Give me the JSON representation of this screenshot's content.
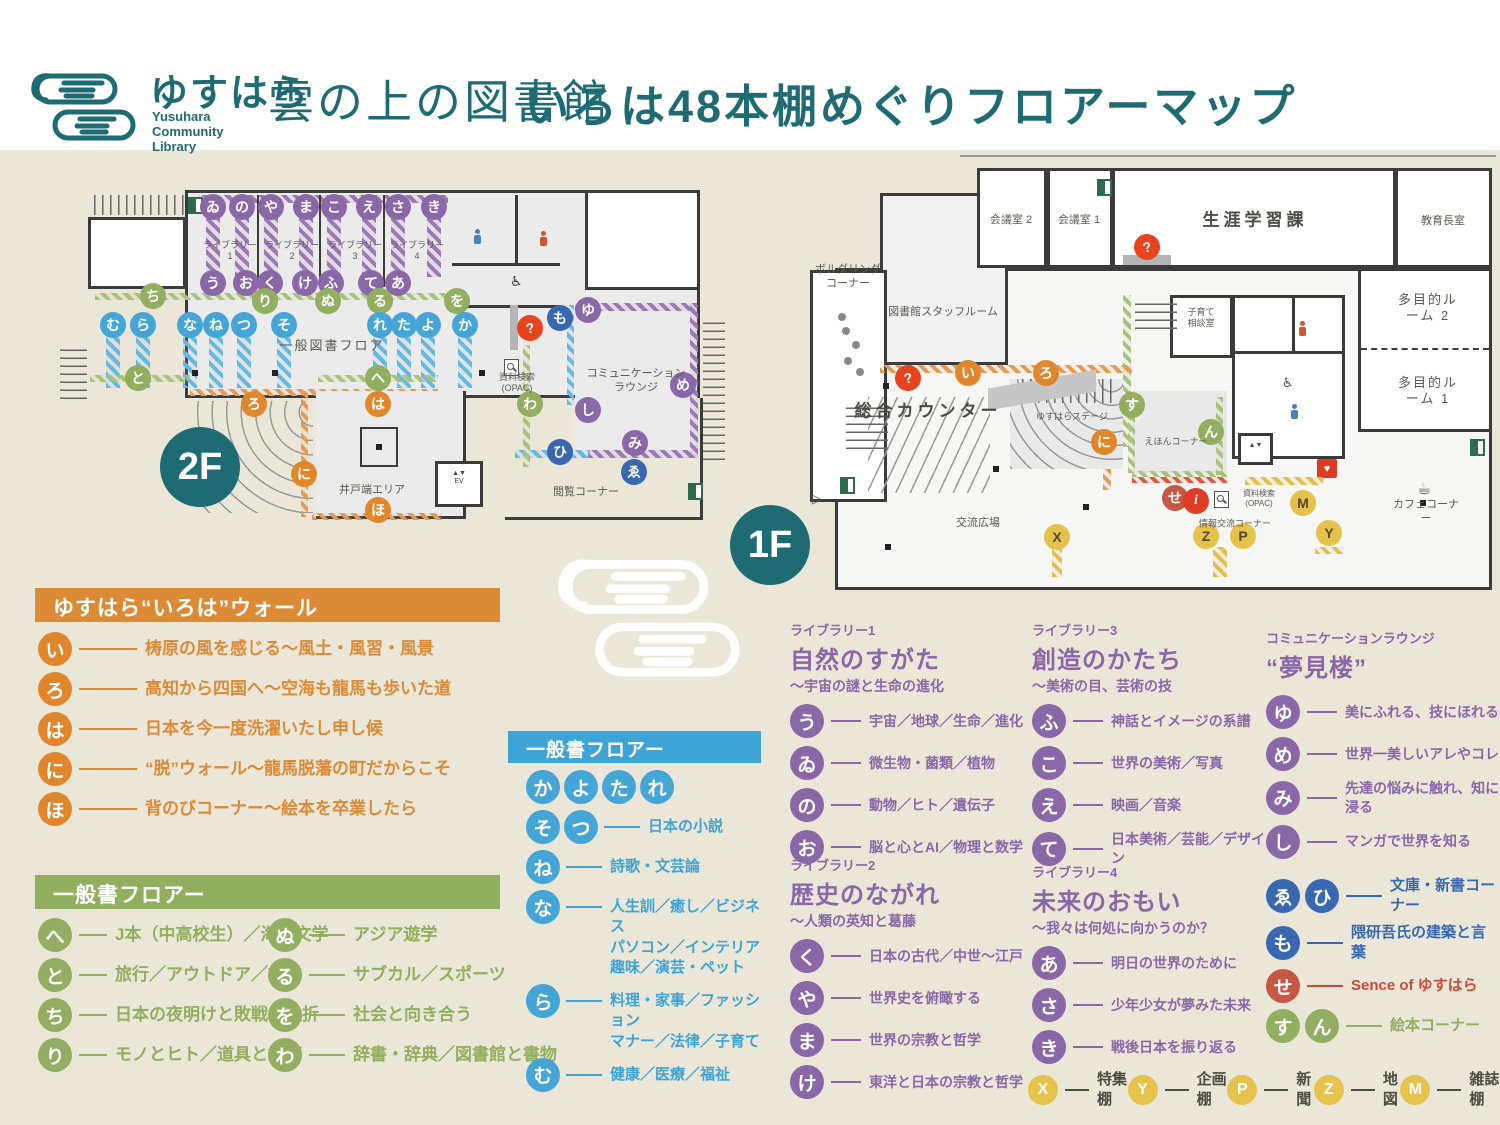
{
  "header": {
    "brand_jp": "ゆすはら",
    "brand_en": "Yusuhara\nCommunity\nLibrary",
    "brand_logotype": "雲の上の図書館",
    "title": "いろは48本棚めぐりフロアーマップ"
  },
  "colors": {
    "teal": "#1e6b74",
    "orange": "#dd8a36",
    "green": "#92ae5f",
    "blue": "#3ea3d5",
    "purple": "#8a67a6",
    "navy": "#3a68b0",
    "brick": "#cb4a35",
    "red": "#e8431f",
    "yellow": "#e5c24c",
    "cream": "#eae6d8",
    "ink": "#3b3b3c"
  },
  "floor2": {
    "badge": "2F",
    "markers": [
      {
        "ch": "ゐ",
        "c": "purple",
        "x": 153,
        "y": 42
      },
      {
        "ch": "の",
        "c": "purple",
        "x": 182,
        "y": 42
      },
      {
        "ch": "や",
        "c": "purple",
        "x": 211,
        "y": 42
      },
      {
        "ch": "ま",
        "c": "purple",
        "x": 246,
        "y": 42
      },
      {
        "ch": "こ",
        "c": "purple",
        "x": 274,
        "y": 42
      },
      {
        "ch": "え",
        "c": "purple",
        "x": 309,
        "y": 42
      },
      {
        "ch": "さ",
        "c": "purple",
        "x": 338,
        "y": 42
      },
      {
        "ch": "き",
        "c": "purple",
        "x": 374,
        "y": 42
      },
      {
        "ch": "う",
        "c": "purple",
        "x": 153,
        "y": 118
      },
      {
        "ch": "お",
        "c": "purple",
        "x": 186,
        "y": 118
      },
      {
        "ch": "く",
        "c": "purple",
        "x": 210,
        "y": 118
      },
      {
        "ch": "け",
        "c": "purple",
        "x": 245,
        "y": 118
      },
      {
        "ch": "ふ",
        "c": "purple",
        "x": 271,
        "y": 118
      },
      {
        "ch": "て",
        "c": "purple",
        "x": 311,
        "y": 118
      },
      {
        "ch": "あ",
        "c": "purple",
        "x": 338,
        "y": 118
      },
      {
        "ch": "ち",
        "c": "green",
        "x": 93,
        "y": 131
      },
      {
        "ch": "り",
        "c": "green",
        "x": 205,
        "y": 136
      },
      {
        "ch": "ぬ",
        "c": "green",
        "x": 268,
        "y": 136
      },
      {
        "ch": "る",
        "c": "green",
        "x": 320,
        "y": 136
      },
      {
        "ch": "を",
        "c": "green",
        "x": 397,
        "y": 136
      },
      {
        "ch": "と",
        "c": "green",
        "x": 78,
        "y": 213
      },
      {
        "ch": "へ",
        "c": "green",
        "x": 318,
        "y": 213
      },
      {
        "ch": "わ",
        "c": "green",
        "x": 470,
        "y": 239
      },
      {
        "ch": "む",
        "c": "blue",
        "x": 53,
        "y": 160
      },
      {
        "ch": "ら",
        "c": "blue",
        "x": 83,
        "y": 160
      },
      {
        "ch": "な",
        "c": "blue",
        "x": 130,
        "y": 160
      },
      {
        "ch": "ね",
        "c": "blue",
        "x": 156,
        "y": 160
      },
      {
        "ch": "つ",
        "c": "blue",
        "x": 184,
        "y": 160
      },
      {
        "ch": "そ",
        "c": "blue",
        "x": 224,
        "y": 160
      },
      {
        "ch": "れ",
        "c": "blue",
        "x": 320,
        "y": 160
      },
      {
        "ch": "た",
        "c": "blue",
        "x": 344,
        "y": 160
      },
      {
        "ch": "よ",
        "c": "blue",
        "x": 368,
        "y": 160
      },
      {
        "ch": "か",
        "c": "blue",
        "x": 405,
        "y": 160
      },
      {
        "ch": "ろ",
        "c": "orange",
        "x": 194,
        "y": 239
      },
      {
        "ch": "は",
        "c": "orange",
        "x": 318,
        "y": 239
      },
      {
        "ch": "に",
        "c": "orange",
        "x": 244,
        "y": 309
      },
      {
        "ch": "ほ",
        "c": "orange",
        "x": 318,
        "y": 345
      },
      {
        "ch": "も",
        "c": "navy",
        "x": 500,
        "y": 153
      },
      {
        "ch": "ひ",
        "c": "navy",
        "x": 500,
        "y": 287
      },
      {
        "ch": "ゑ",
        "c": "navy",
        "x": 574,
        "y": 307
      },
      {
        "ch": "ゆ",
        "c": "purple",
        "x": 528,
        "y": 145
      },
      {
        "ch": "し",
        "c": "purple",
        "x": 528,
        "y": 245
      },
      {
        "ch": "め",
        "c": "purple",
        "x": 623,
        "y": 220
      },
      {
        "ch": "み",
        "c": "purple",
        "x": 575,
        "y": 278
      },
      {
        "ch": "?",
        "c": "help",
        "x": 470,
        "y": 163
      }
    ],
    "labels": [
      {
        "t": "ライブラリー\n1",
        "x": 170,
        "y": 86,
        "s": "xs"
      },
      {
        "t": "ライブラリー\n2",
        "x": 232,
        "y": 86,
        "s": "xs"
      },
      {
        "t": "ライブラリー\n3",
        "x": 295,
        "y": 86,
        "s": "xs"
      },
      {
        "t": "ライブラリー\n4",
        "x": 357,
        "y": 86,
        "s": "xs"
      },
      {
        "t": "一般図書フロア",
        "x": 272,
        "y": 181,
        "s": "md"
      },
      {
        "t": "井戸端エリア",
        "x": 312,
        "y": 326,
        "s": "sm"
      },
      {
        "t": "コミュニケーション\nラウンジ",
        "x": 576,
        "y": 216,
        "s": "sm"
      },
      {
        "t": "閲覧コーナー",
        "x": 526,
        "y": 328,
        "s": "sm"
      },
      {
        "t": "資料検索\n(OPAC)",
        "x": 457,
        "y": 218,
        "s": "xs"
      }
    ]
  },
  "floor1": {
    "badge": "1F",
    "markers": [
      {
        "ch": "?",
        "c": "help",
        "x": 98,
        "y": 223
      },
      {
        "ch": "?",
        "c": "help",
        "x": 337,
        "y": 92
      },
      {
        "ch": "い",
        "c": "orange",
        "x": 158,
        "y": 218
      },
      {
        "ch": "ろ",
        "c": "orange",
        "x": 236,
        "y": 218
      },
      {
        "ch": "に",
        "c": "orange",
        "x": 294,
        "y": 287
      },
      {
        "ch": "す",
        "c": "green",
        "x": 322,
        "y": 250
      },
      {
        "ch": "ん",
        "c": "green",
        "x": 401,
        "y": 277
      },
      {
        "ch": "せ",
        "c": "brick",
        "x": 365,
        "y": 343
      },
      {
        "ch": "i",
        "c": "info",
        "x": 386,
        "y": 346
      },
      {
        "ch": "M",
        "c": "yellow",
        "x": 493,
        "y": 348
      },
      {
        "ch": "X",
        "c": "yellow",
        "x": 247,
        "y": 382
      },
      {
        "ch": "Z",
        "c": "yellow",
        "x": 396,
        "y": 381
      },
      {
        "ch": "P",
        "c": "yellow",
        "x": 433,
        "y": 381
      },
      {
        "ch": "Y",
        "c": "yellow",
        "x": 519,
        "y": 378
      }
    ],
    "labels": [
      {
        "t": "ボルダリング\nコーナー",
        "x": 38,
        "y": 122,
        "s": "sm"
      },
      {
        "t": "図書館スタッフルーム",
        "x": 133,
        "y": 158,
        "s": "sm"
      },
      {
        "t": "会議室 2",
        "x": 201,
        "y": 66,
        "s": "sm"
      },
      {
        "t": "会議室 1",
        "x": 269,
        "y": 66,
        "s": "sm"
      },
      {
        "t": "生涯学習課",
        "x": 445,
        "y": 65,
        "s": "lg"
      },
      {
        "t": "教育長室",
        "x": 633,
        "y": 67,
        "s": "sm"
      },
      {
        "t": "多目的ルーム 2",
        "x": 618,
        "y": 153,
        "s": "md"
      },
      {
        "t": "多目的ルーム 1",
        "x": 618,
        "y": 236,
        "s": "md"
      },
      {
        "t": "子育て\n相談室",
        "x": 391,
        "y": 163,
        "s": "xs"
      },
      {
        "t": "総合カウンター",
        "x": 118,
        "y": 256,
        "s": "lg"
      },
      {
        "t": "ゆすはらステージ",
        "x": 262,
        "y": 262,
        "s": "xs"
      },
      {
        "t": "えほんコーナー",
        "x": 366,
        "y": 287,
        "s": "xs"
      },
      {
        "t": "交流広場",
        "x": 168,
        "y": 369,
        "s": "sm"
      },
      {
        "t": "情報交流コーナー",
        "x": 425,
        "y": 369,
        "s": "xs"
      },
      {
        "t": "カフェコーナー",
        "x": 616,
        "y": 357,
        "s": "sm"
      },
      {
        "t": "資料検索\n(OPAC)",
        "x": 449,
        "y": 344,
        "s": "xxs"
      }
    ]
  },
  "legend_orange": {
    "title": "ゆすはら“いろは”ウォール",
    "items": [
      {
        "ch": "い",
        "text": "梼原の風を感じる〜風土・風習・風景"
      },
      {
        "ch": "ろ",
        "text": "高知から四国へ〜空海も龍馬も歩いた道"
      },
      {
        "ch": "は",
        "text": "日本を今一度洗濯いたし申し候"
      },
      {
        "ch": "に",
        "text": "“脱”ウォール〜龍馬脱藩の町だからこそ"
      },
      {
        "ch": "ほ",
        "text": "背のびコーナー〜絵本を卒業したら"
      }
    ]
  },
  "legend_green": {
    "title": "一般書フロアー",
    "items_left": [
      {
        "ch": "へ",
        "text": "J本（中高校生）／海外文学"
      },
      {
        "ch": "と",
        "text": "旅行／アウトドア／語学"
      },
      {
        "ch": "ち",
        "text": "日本の夜明けと敗戦の挫折"
      },
      {
        "ch": "り",
        "text": "モノとヒト／道具と技術"
      }
    ],
    "items_right": [
      {
        "ch": "ぬ",
        "text": "アジア遊学"
      },
      {
        "ch": "る",
        "text": "サブカル／スポーツ"
      },
      {
        "ch": "を",
        "text": "社会と向き合う"
      },
      {
        "ch": "わ",
        "text": "辞書・辞典／図書館と書物"
      }
    ]
  },
  "legend_blue": {
    "title": "一般書フロアー",
    "groups": [
      {
        "chars": [
          "か",
          "よ",
          "た",
          "れ"
        ],
        "text": ""
      },
      {
        "chars": [
          "そ",
          "つ"
        ],
        "text": "日本の小説"
      },
      {
        "chars": [
          "ね"
        ],
        "text": "詩歌・文芸論"
      },
      {
        "chars": [
          "な"
        ],
        "text": "人生訓／癒し／ビジネス\nパソコン／インテリア\n趣味／演芸・ペット"
      },
      {
        "chars": [
          "ら"
        ],
        "text": "料理・家事／ファッション\nマナー／法律／子育て"
      },
      {
        "chars": [
          "む"
        ],
        "text": "健康／医療／福祉"
      }
    ]
  },
  "libraries": [
    {
      "tag": "ライブラリー1",
      "title": "自然のすがた",
      "subtitle": "〜宇宙の謎と生命の進化",
      "items": [
        {
          "ch": "う",
          "text": "宇宙／地球／生命／進化"
        },
        {
          "ch": "ゐ",
          "text": "微生物・菌類／植物"
        },
        {
          "ch": "の",
          "text": "動物／ヒト／遺伝子"
        },
        {
          "ch": "お",
          "text": "脳と心とAI／物理と数学"
        }
      ]
    },
    {
      "tag": "ライブラリー2",
      "title": "歴史のながれ",
      "subtitle": "〜人類の英知と葛藤",
      "items": [
        {
          "ch": "く",
          "text": "日本の古代／中世〜江戸"
        },
        {
          "ch": "や",
          "text": "世界史を俯瞰する"
        },
        {
          "ch": "ま",
          "text": "世界の宗教と哲学"
        },
        {
          "ch": "け",
          "text": "東洋と日本の宗教と哲学"
        }
      ]
    },
    {
      "tag": "ライブラリー3",
      "title": "創造のかたち",
      "subtitle": "〜美術の目、芸術の技",
      "items": [
        {
          "ch": "ふ",
          "text": "神話とイメージの系譜"
        },
        {
          "ch": "こ",
          "text": "世界の美術／写真"
        },
        {
          "ch": "え",
          "text": "映画／音楽"
        },
        {
          "ch": "て",
          "text": "日本美術／芸能／デザイン"
        }
      ]
    },
    {
      "tag": "ライブラリー4",
      "title": "未来のおもい",
      "subtitle": "〜我々は何処に向かうのか？",
      "items": [
        {
          "ch": "あ",
          "text": "明日の世界のために"
        },
        {
          "ch": "さ",
          "text": "少年少女が夢みた未来"
        },
        {
          "ch": "き",
          "text": "戦後日本を振り返る"
        }
      ]
    }
  ],
  "lounge": {
    "tag": "コミュニケーションラウンジ",
    "title": "“夢見楼”",
    "items": [
      {
        "ch": "ゆ",
        "text": "美にふれる、技にほれる"
      },
      {
        "ch": "め",
        "text": "世界一美しいアレやコレ"
      },
      {
        "ch": "み",
        "text": "先達の悩みに触れ、知に浸る"
      },
      {
        "ch": "し",
        "text": "マンガで世界を知る"
      }
    ]
  },
  "misc_items": [
    {
      "chars": [
        "ゑ",
        "ひ"
      ],
      "color": "navy",
      "text": "文庫・新書コーナー"
    },
    {
      "chars": [
        "も"
      ],
      "color": "navy",
      "text": "隈研吾氏の建築と言葉"
    },
    {
      "chars": [
        "せ"
      ],
      "color": "brick",
      "text": "Sence of ゆすはら"
    },
    {
      "chars": [
        "す",
        "ん"
      ],
      "color": "green",
      "text": "絵本コーナー"
    }
  ],
  "shelf_legend": [
    {
      "ch": "X",
      "text": "特集棚"
    },
    {
      "ch": "Y",
      "text": "企画棚"
    },
    {
      "ch": "P",
      "text": "新聞"
    },
    {
      "ch": "Z",
      "text": "地図"
    },
    {
      "ch": "M",
      "text": "雑誌棚"
    }
  ],
  "icons": {
    "aed": "♥",
    "wheelchair": "♿",
    "coffee": "☕",
    "arrow_left": "▷",
    "elevator": "▲▼"
  }
}
